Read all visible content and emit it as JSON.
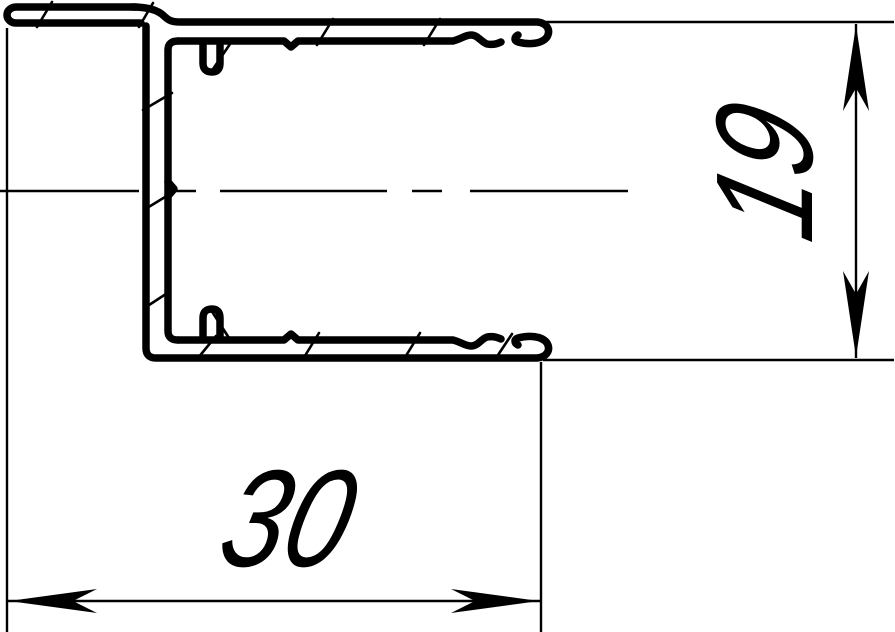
{
  "drawing": {
    "kind": "profile-cross-section",
    "colors": {
      "line": "#000000",
      "background": "#ffffff"
    },
    "dimensions": {
      "width": "30",
      "height": "19"
    }
  }
}
